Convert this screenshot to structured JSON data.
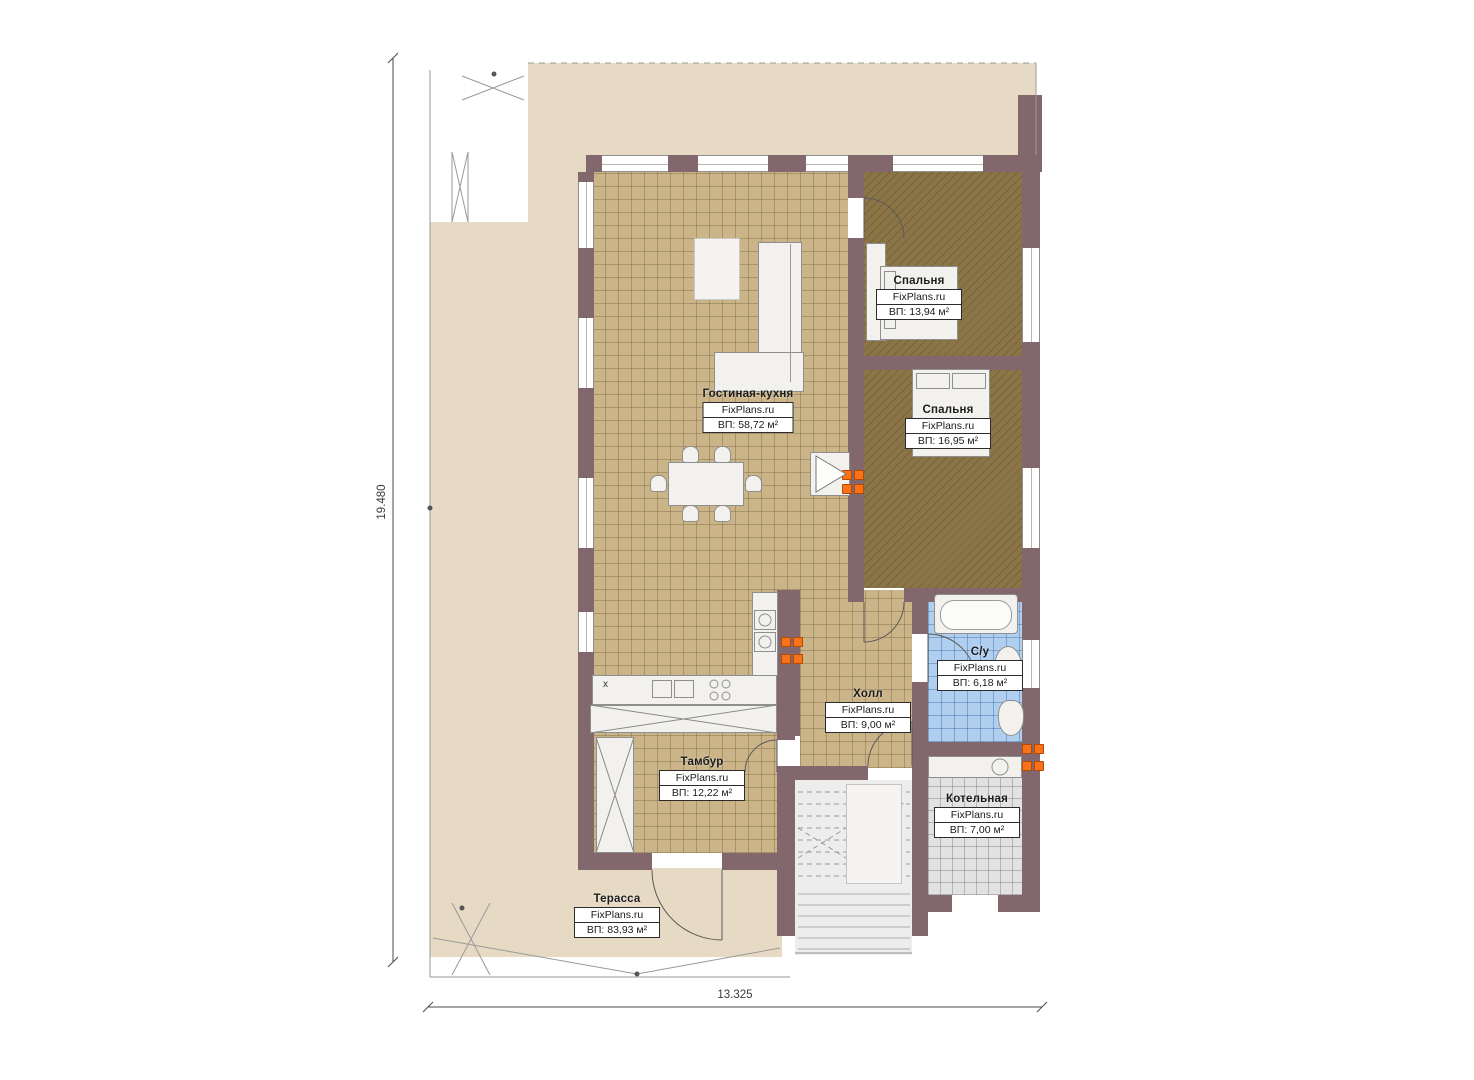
{
  "plan": {
    "title": "Floor plan",
    "brand": "FixPlans.ru",
    "dimensions": {
      "vertical": "19.480",
      "horizontal": "13.325"
    },
    "kitchen_marker": "x",
    "rooms": [
      {
        "name": "Гостиная-кухня",
        "brand": "FixPlans.ru",
        "area": "ВП: 58,72 м²"
      },
      {
        "name": "Спальня",
        "brand": "FixPlans.ru",
        "area": "ВП: 13,94 м²"
      },
      {
        "name": "Спальня",
        "brand": "FixPlans.ru",
        "area": "ВП: 16,95 м²"
      },
      {
        "name": "С/у",
        "brand": "FixPlans.ru",
        "area": "ВП: 6,18 м²"
      },
      {
        "name": "Холл",
        "brand": "FixPlans.ru",
        "area": "ВП: 9,00 м²"
      },
      {
        "name": "Тамбур",
        "brand": "FixPlans.ru",
        "area": "ВП: 12,22 м²"
      },
      {
        "name": "Котельная",
        "brand": "FixPlans.ru",
        "area": "ВП: 7,00 м²"
      },
      {
        "name": "Терасса",
        "brand": "FixPlans.ru",
        "area": "ВП: 83,93 м²"
      }
    ],
    "colors": {
      "wall": "#82686d",
      "terrace": "#e7dac4",
      "tile": "#cbb488",
      "carpet": "#8b7446",
      "bathroom_tile": "#b0cfee",
      "boiler_tile": "#e2e2e2",
      "socket": "#f97316"
    }
  }
}
